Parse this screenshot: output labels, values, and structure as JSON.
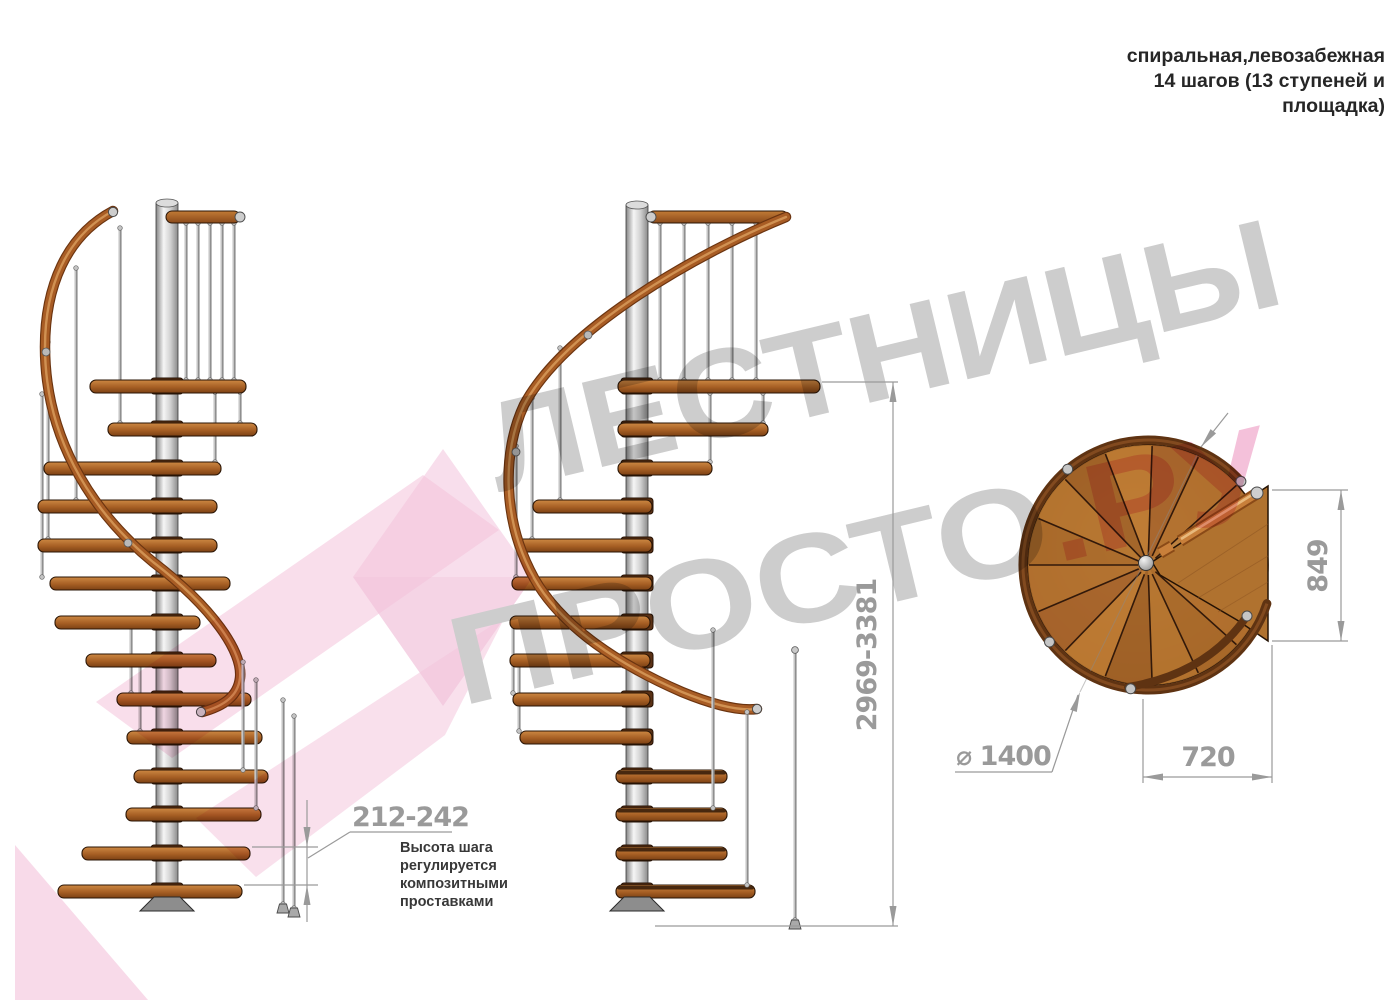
{
  "header": {
    "line1": "спиральная,левозабежная",
    "line2": "14 шагов (13 ступеней и",
    "line3": "площадка)"
  },
  "watermark": {
    "word1": "ЛЕСТНИЦЫ",
    "word2": "ПРОСТО",
    "word2_suffix": ".РУ",
    "gray": "#c9c9c9",
    "pink": "#f4bcd7"
  },
  "dimensions": {
    "step_height": {
      "value": "212-242",
      "note": [
        "Высота шага",
        "регулируется",
        "композитными",
        "проставками"
      ]
    },
    "total_height": "2969-3381",
    "landing_depth": "849",
    "landing_width": "720",
    "diameter": {
      "label": "⌀ 1400"
    }
  },
  "colors": {
    "wood_step": "#a65f24",
    "handrail": "#a85c24",
    "pole": "#d2d2d2",
    "plan_wood": "#a86a2e",
    "dimension_gray": "#9a9a9a",
    "note_text": "#383838"
  }
}
